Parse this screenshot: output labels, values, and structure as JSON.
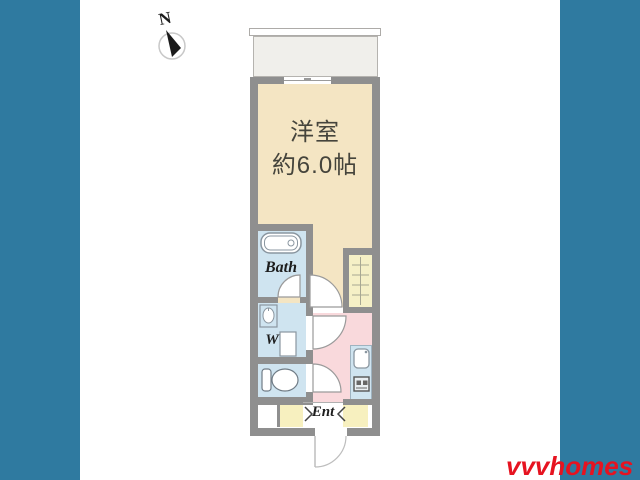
{
  "labels": {
    "compass": "N",
    "main_room_line1": "洋室",
    "main_room_line2": "約6.0帖",
    "bath": "Bath",
    "washer": "W",
    "entrance": "Ent"
  },
  "watermark": {
    "letter": "W",
    "word": "homes"
  },
  "brand": {
    "name": "vvvhomes",
    "color": "#e61320"
  },
  "colors": {
    "side_band": "#2f7aa0",
    "main_room": "#f4e5c3",
    "wet_area": "#cfe4f0",
    "hallway": "#f9d9dc",
    "entrance_tile": "#f7f0bf",
    "closet": "#f5f0c6",
    "balcony": "#f0efeb",
    "wall": "#8f8f8f"
  }
}
